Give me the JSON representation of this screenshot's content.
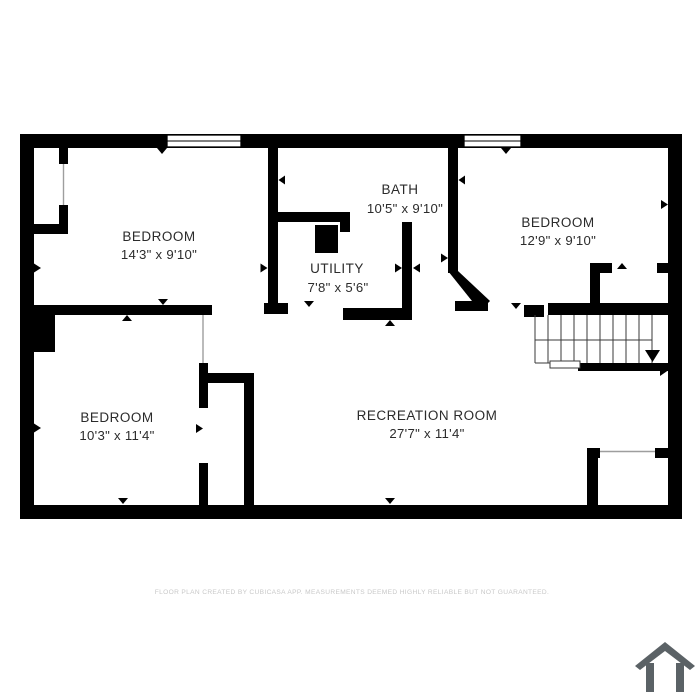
{
  "colors": {
    "background": "#ffffff",
    "wall": "#000000",
    "room_text": "#2b2b2b",
    "disclaimer_text": "#c8c8c8",
    "logo": "#5b6266"
  },
  "rooms": [
    {
      "name": "BEDROOM",
      "dimensions": "14'3\" x 9'10\""
    },
    {
      "name": "BATH",
      "dimensions": "10'5\" x 9'10\""
    },
    {
      "name": "BEDROOM",
      "dimensions": "12'9\" x 9'10\""
    },
    {
      "name": "UTILITY",
      "dimensions": "7'8\" x 5'6\""
    },
    {
      "name": "BEDROOM",
      "dimensions": "10'3\" x 11'4\""
    },
    {
      "name": "RECREATION ROOM",
      "dimensions": "27'7\" x 11'4\""
    }
  ],
  "stairs": {
    "direction": "down"
  },
  "disclaimer": "FLOOR PLAN CREATED BY CUBICASA APP. MEASUREMENTS DEEMED HIGHLY RELIABLE BUT NOT GUARANTEED.",
  "logo": {
    "name": "cubicasa-house-logo"
  }
}
